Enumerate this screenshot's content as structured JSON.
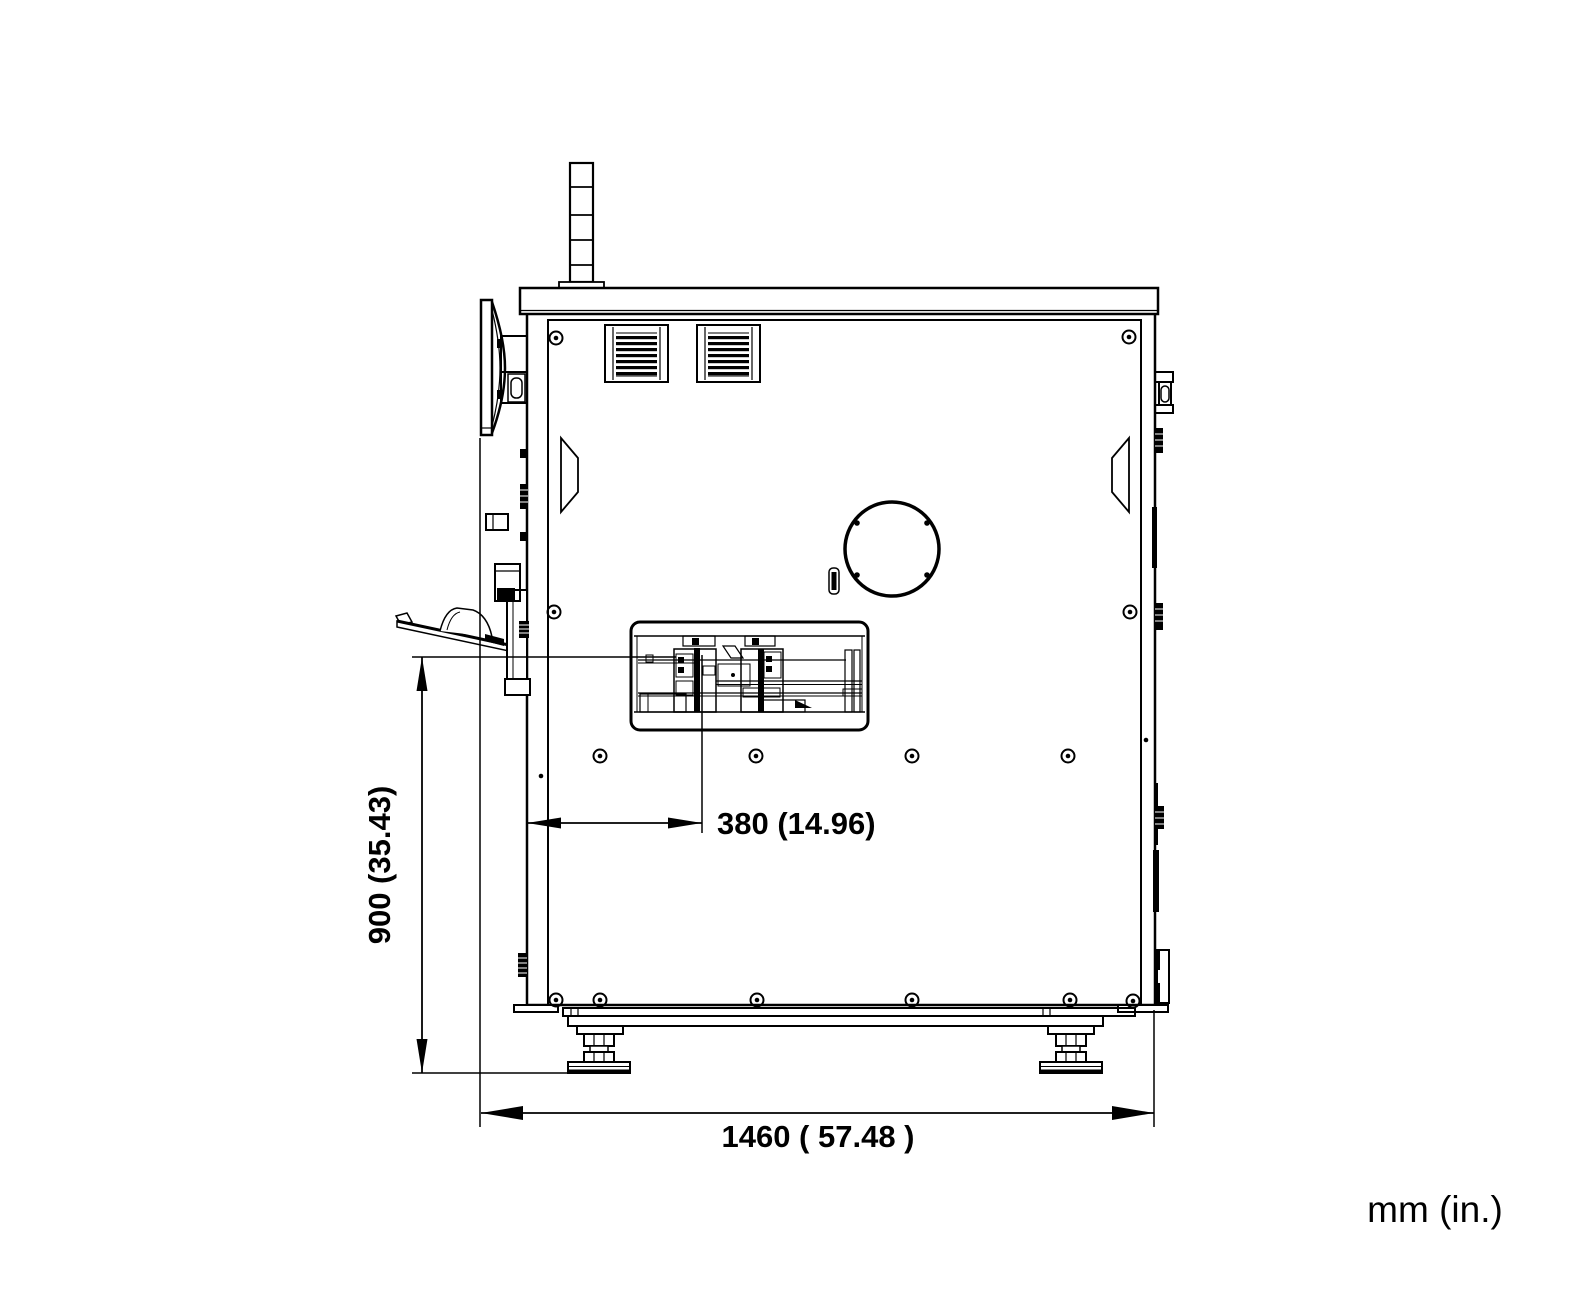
{
  "drawing": {
    "units_label": "mm (in.)",
    "dimensions": {
      "height": {
        "label": "900 (35.43)"
      },
      "offset": {
        "label": "380 (14.96)"
      },
      "width": {
        "label": "1460 ( 57.48 )"
      }
    },
    "colors": {
      "line": "#000000",
      "background": "#ffffff"
    }
  }
}
